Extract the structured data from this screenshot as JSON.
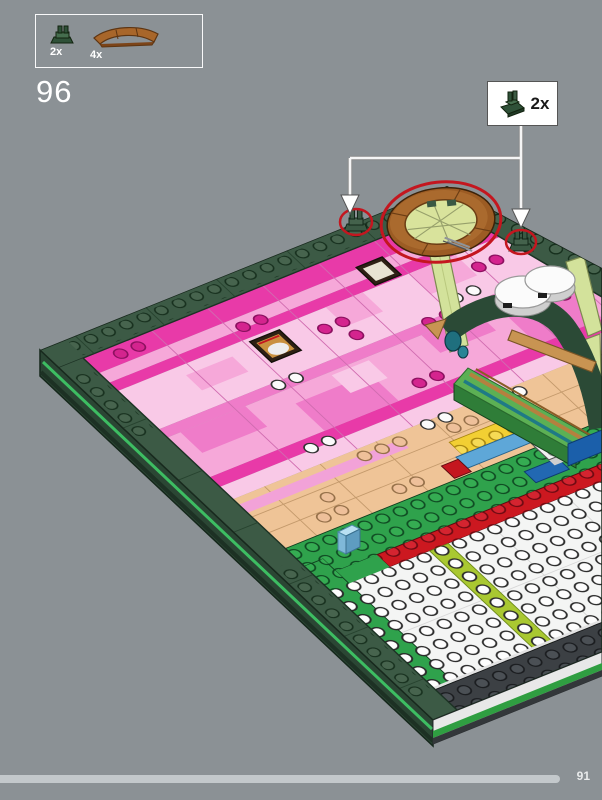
{
  "page": {
    "background_color": "#8b9195"
  },
  "parts_panel": {
    "items": [
      {
        "part": "dark-green-plate-with-clip",
        "count": "2x"
      },
      {
        "part": "dark-orange-curved-arch-brick",
        "count": "4x"
      }
    ]
  },
  "step_number": "96",
  "callout": {
    "part": "dark-green-plate-with-clip",
    "count": "2x"
  },
  "footer": {
    "page_number": "91",
    "progress_style": "width:560px"
  },
  "colors": {
    "background": "#8b9195",
    "highlight_red": "#c4161f",
    "frame_green": "#3c5a45",
    "side_stripe_green": "#3dbd62",
    "ring_brown": "#9c5c24",
    "pink_magenta": "#e83aa8",
    "pink_light": "#f6a8d9",
    "tan": "#efc497",
    "row_green": "#2fa24c",
    "progress_bar": "#c3c8cb"
  }
}
